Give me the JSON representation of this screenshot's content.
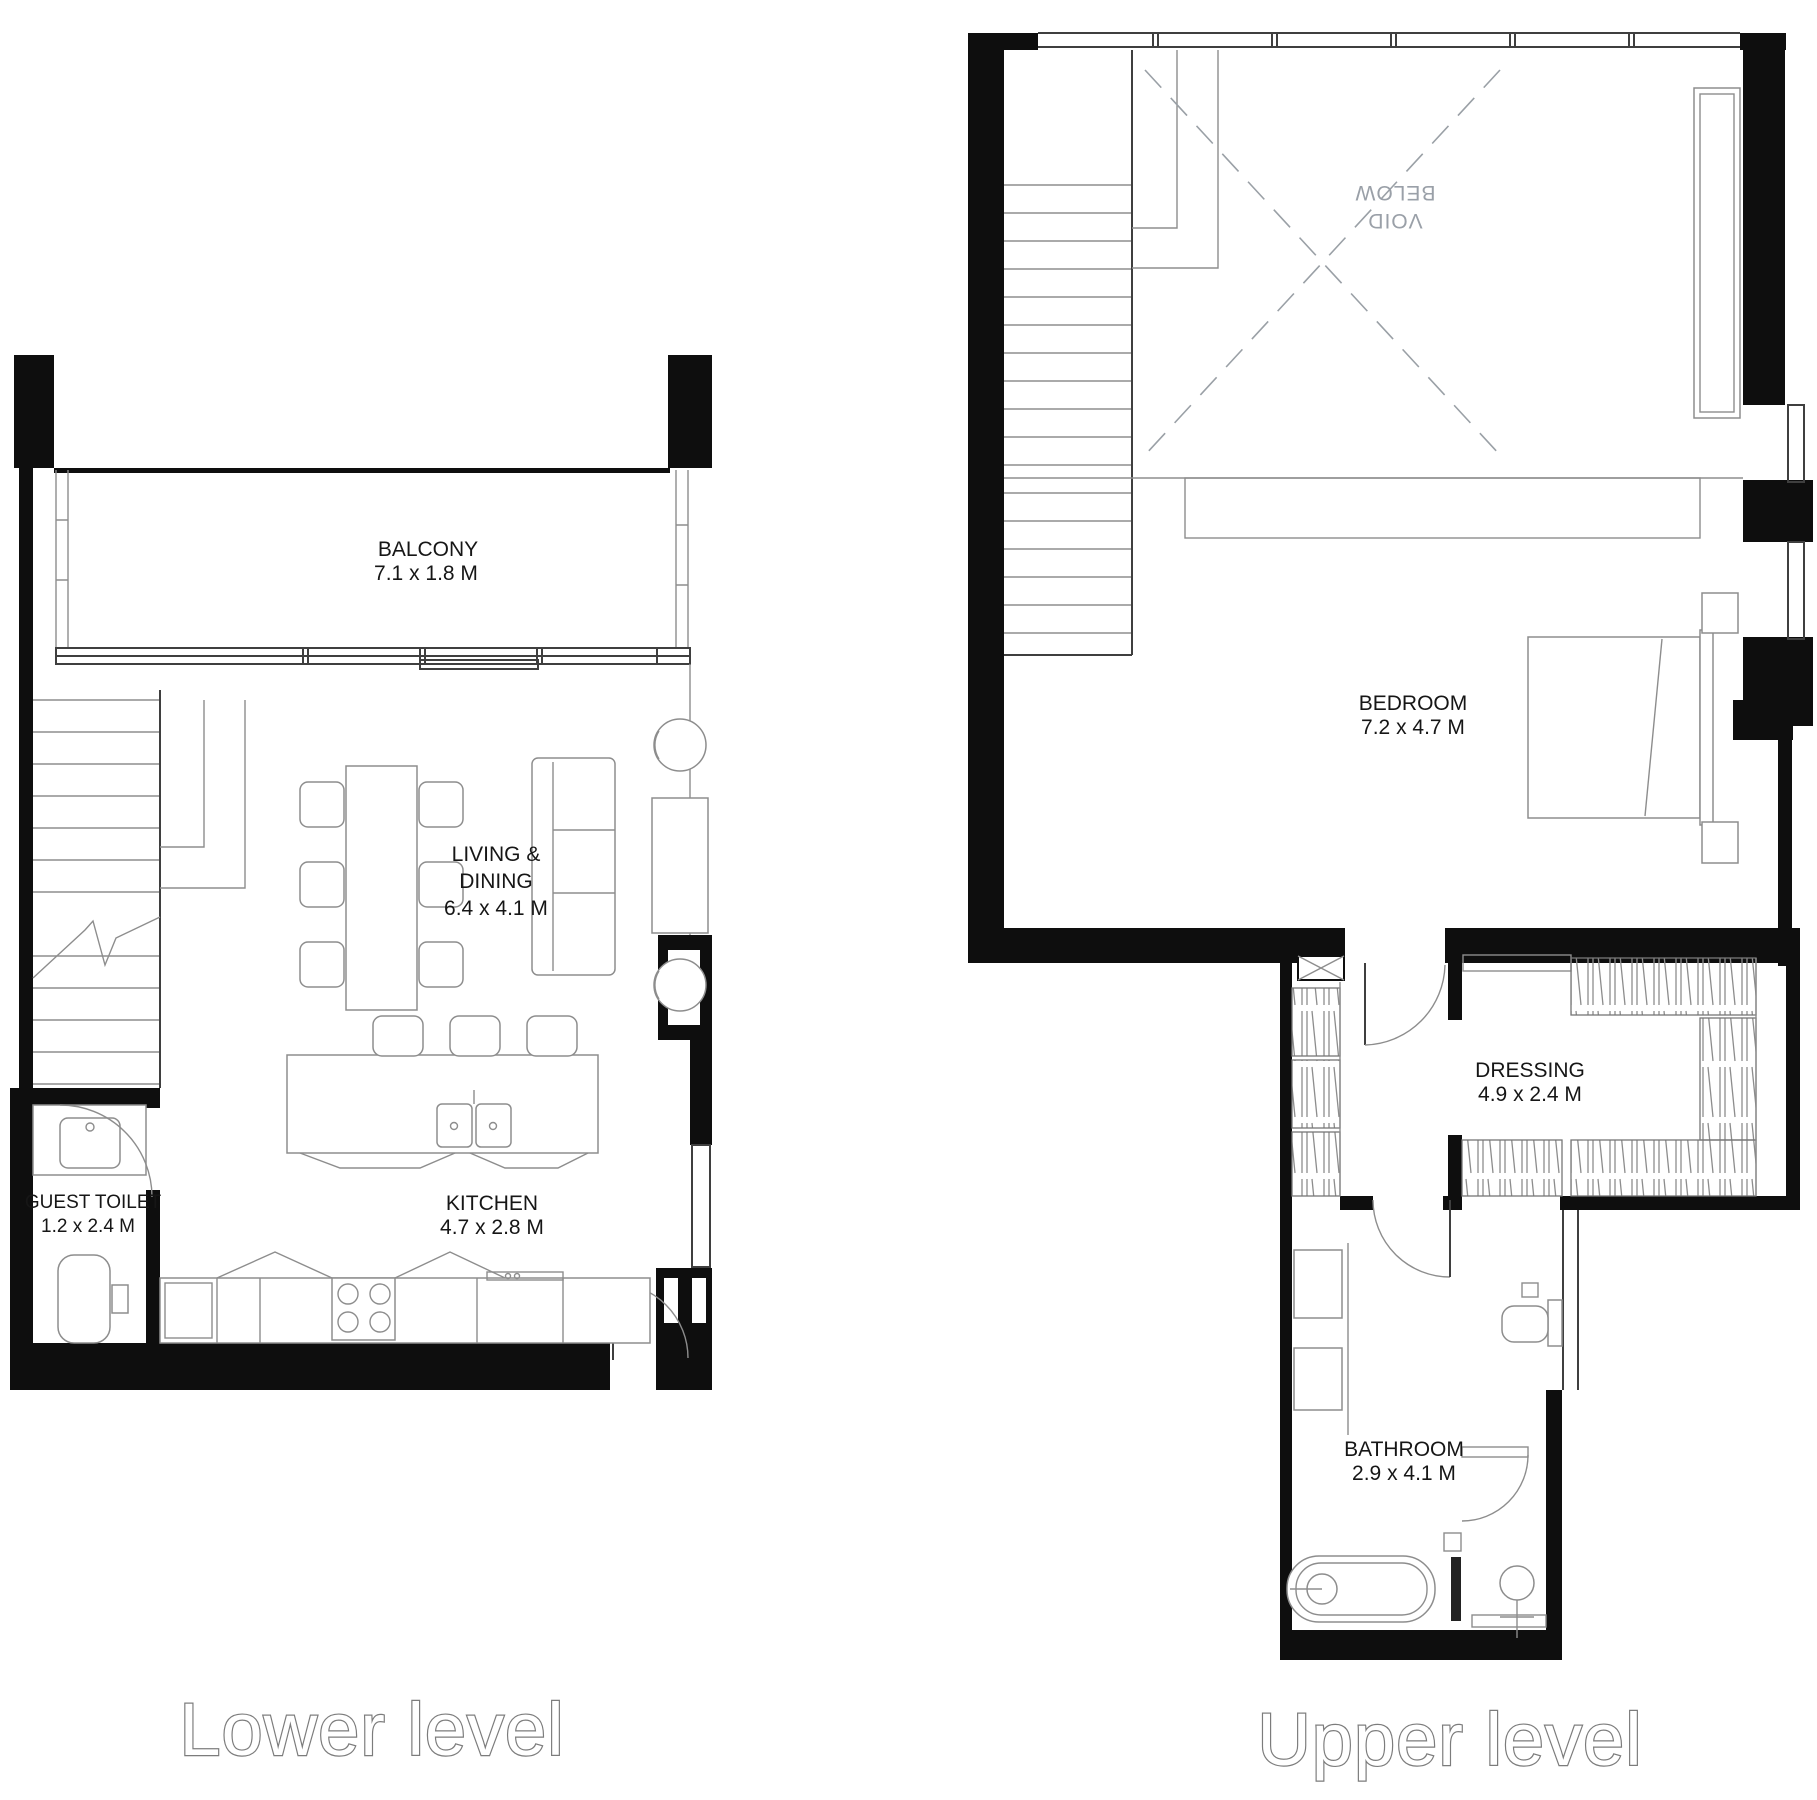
{
  "document": {
    "type": "floor-plan",
    "background": "#ffffff"
  },
  "colors": {
    "wall": "#0e0e0e",
    "furniture_line": "#8d8d8d",
    "void_text": "#9aa0a8",
    "caption_outline": "#7c7c7c"
  },
  "lower": {
    "caption": "Lower level",
    "balcony": {
      "name": "BALCONY",
      "dims": "7.1 x 1.8 M"
    },
    "living": {
      "name_line1": "LIVING &",
      "name_line2": "DINING",
      "dims": "6.4 x 4.1 M"
    },
    "guest_toilet": {
      "name": "GUEST TOILET",
      "dims": "1.2 x 2.4 M"
    },
    "kitchen": {
      "name": "KITCHEN",
      "dims": "4.7 x 2.8 M"
    }
  },
  "upper": {
    "caption": "Upper level",
    "void": {
      "line1": "VOID",
      "line2": "BELOW"
    },
    "bedroom": {
      "name": "BEDROOM",
      "dims": "7.2 x 4.7 M"
    },
    "dressing": {
      "name": "DRESSING",
      "dims": "4.9 x 2.4 M"
    },
    "bathroom": {
      "name": "BATHROOM",
      "dims": "2.9 x 4.1 M"
    }
  }
}
